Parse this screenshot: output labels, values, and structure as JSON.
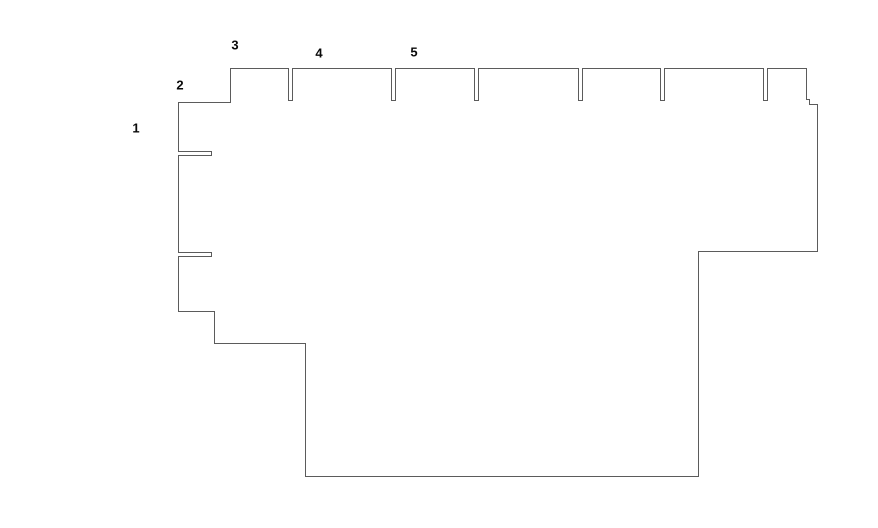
{
  "canvas": {
    "width": 878,
    "height": 528,
    "background_color": "#ffffff",
    "line_color": "#5b5b5b",
    "line_width": 1,
    "label_color": "#0a0a0a"
  },
  "labels": [
    {
      "text": "1",
      "x": 136,
      "y": 128
    },
    {
      "text": "2",
      "x": 180,
      "y": 85
    },
    {
      "text": "3",
      "x": 235,
      "y": 45
    },
    {
      "text": "4",
      "x": 319,
      "y": 53
    },
    {
      "text": "5",
      "x": 414,
      "y": 52
    }
  ],
  "outline": {
    "description": "floor-plan outline with partition stubs, single closed polyline",
    "closed": true,
    "points": [
      [
        178,
        102
      ],
      [
        230,
        102
      ],
      [
        230,
        68
      ],
      [
        288,
        68
      ],
      [
        288,
        100
      ],
      [
        292,
        100
      ],
      [
        292,
        68
      ],
      [
        391,
        68
      ],
      [
        391,
        100
      ],
      [
        395,
        100
      ],
      [
        395,
        68
      ],
      [
        474,
        68
      ],
      [
        474,
        100
      ],
      [
        478,
        100
      ],
      [
        478,
        68
      ],
      [
        578,
        68
      ],
      [
        578,
        100
      ],
      [
        582,
        100
      ],
      [
        582,
        68
      ],
      [
        660,
        68
      ],
      [
        660,
        100
      ],
      [
        664,
        100
      ],
      [
        664,
        68
      ],
      [
        763,
        68
      ],
      [
        763,
        100
      ],
      [
        767,
        100
      ],
      [
        767,
        68
      ],
      [
        806,
        68
      ],
      [
        806,
        99
      ],
      [
        809,
        99
      ],
      [
        809,
        104
      ],
      [
        817,
        104
      ],
      [
        817,
        251
      ],
      [
        698,
        251
      ],
      [
        698,
        476
      ],
      [
        305,
        476
      ],
      [
        305,
        343
      ],
      [
        214,
        343
      ],
      [
        214,
        311
      ],
      [
        178,
        311
      ],
      [
        178,
        256
      ],
      [
        211,
        256
      ],
      [
        211,
        252
      ],
      [
        178,
        252
      ],
      [
        178,
        155
      ],
      [
        211,
        155
      ],
      [
        211,
        151
      ],
      [
        178,
        151
      ]
    ]
  }
}
